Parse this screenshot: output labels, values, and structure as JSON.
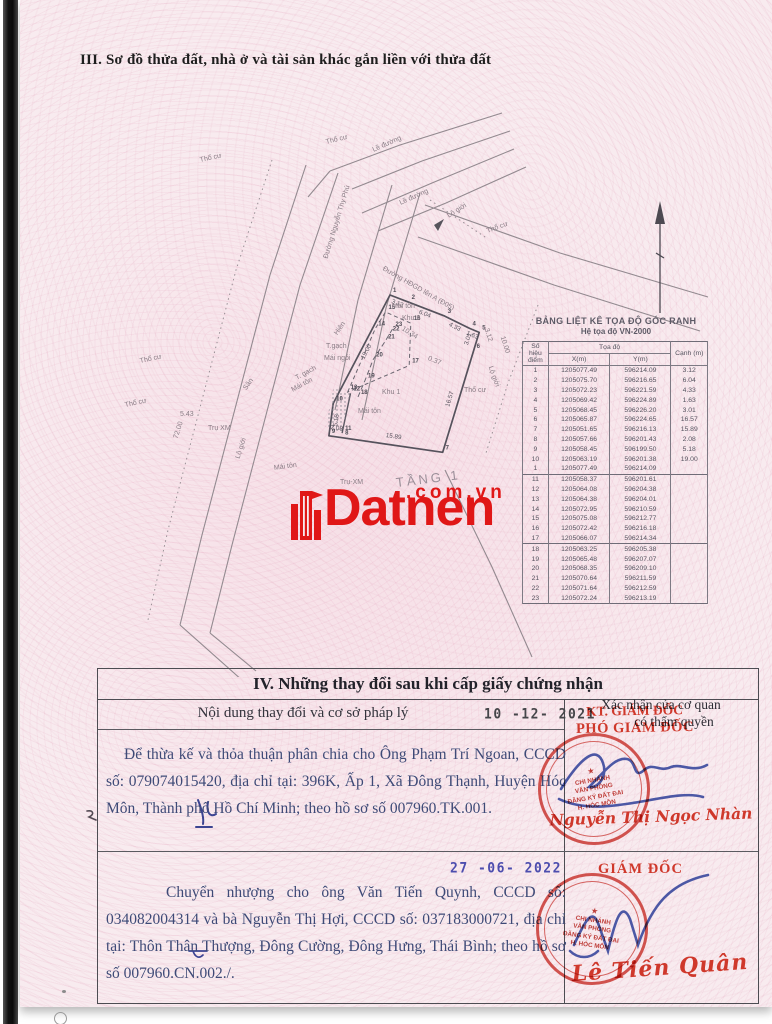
{
  "colors": {
    "stamp_red": "#cf382b",
    "signature_blue": "#3d4b9e",
    "watermark_red": "#e01717",
    "typed_text_blue": "#3e4a77"
  },
  "section3": {
    "title": "III. Sơ đồ thửa đất, nhà ở và tài sản khác gắn liền với thửa đất"
  },
  "coord_table": {
    "title": "BẢNG LIỆT KÊ TỌA ĐỘ GÓC RANH",
    "subtitle": "Hệ tọa độ VN-2000",
    "headers": {
      "point": "Số hiệu điểm",
      "coords": "Tọa độ",
      "x": "X(m)",
      "y": "Y(m)",
      "edge": "Cạnh (m)"
    },
    "rows_part1": [
      [
        "1",
        "1205077.49",
        "596214.09",
        "3.12"
      ],
      [
        "2",
        "1205075.70",
        "596216.65",
        "6.04"
      ],
      [
        "3",
        "1205072.23",
        "596221.59",
        "4.33"
      ],
      [
        "4",
        "1205069.42",
        "596224.89",
        "1.63"
      ],
      [
        "5",
        "1205068.45",
        "596226.20",
        "3.01"
      ],
      [
        "6",
        "1205065.87",
        "596224.65",
        "16.57"
      ],
      [
        "7",
        "1205051.65",
        "596216.13",
        "15.89"
      ],
      [
        "8",
        "1205057.66",
        "596201.43",
        "2.08"
      ],
      [
        "9",
        "1205058.45",
        "596199.50",
        "5.18"
      ],
      [
        "10",
        "1205063.19",
        "596201.38",
        "19.00"
      ],
      [
        "1",
        "1205077.49",
        "596214.09",
        ""
      ]
    ],
    "rows_part2": [
      [
        "11",
        "1205058.37",
        "596201.61",
        ""
      ],
      [
        "12",
        "1205064.08",
        "596204.38",
        ""
      ],
      [
        "13",
        "1205064.38",
        "596204.01",
        ""
      ],
      [
        "14",
        "1205072.95",
        "596210.59",
        ""
      ],
      [
        "15",
        "1205075.08",
        "596212.77",
        ""
      ],
      [
        "16",
        "1205072.42",
        "596216.18",
        ""
      ],
      [
        "17",
        "1205066.07",
        "596214.34",
        ""
      ]
    ],
    "rows_part3": [
      [
        "18",
        "1205063.25",
        "596205.38",
        ""
      ],
      [
        "19",
        "1205065.48",
        "596207.07",
        ""
      ],
      [
        "20",
        "1205068.35",
        "596209.10",
        ""
      ],
      [
        "21",
        "1205070.64",
        "596211.59",
        ""
      ],
      [
        "22",
        "1205071.64",
        "596212.59",
        ""
      ],
      [
        "23",
        "1205072.24",
        "596213.19",
        ""
      ]
    ]
  },
  "map": {
    "labels": [
      {
        "t": "Thổ cư",
        "x": 160,
        "y": 52,
        "r": -12
      },
      {
        "t": "Thổ cư",
        "x": 286,
        "y": 34,
        "r": -14
      },
      {
        "t": "Lề đường",
        "x": 333,
        "y": 42,
        "r": -24
      },
      {
        "t": "Lề đường",
        "x": 360,
        "y": 95,
        "r": -24
      },
      {
        "t": "Lộ giới",
        "x": 408,
        "y": 108,
        "r": -32
      },
      {
        "t": "Thổ cư",
        "x": 447,
        "y": 123,
        "r": -20
      },
      {
        "t": "Đường HĐGD lên A (Đ05)",
        "x": 343,
        "y": 160,
        "r": 30
      },
      {
        "t": "Đường Nguyễn Thy Phú",
        "x": 286,
        "y": 150,
        "r": -73
      },
      {
        "t": "Thổ cư",
        "x": 100,
        "y": 253,
        "r": -12
      },
      {
        "t": "Thổ cư",
        "x": 85,
        "y": 297,
        "r": -12
      },
      {
        "t": "Lộ giới",
        "x": 198,
        "y": 350,
        "r": -72
      },
      {
        "t": "Lộ giới",
        "x": 450,
        "y": 258,
        "r": 70
      },
      {
        "t": "Thổ cư",
        "x": 424,
        "y": 282,
        "r": 0
      },
      {
        "t": "Mái tôn",
        "x": 234,
        "y": 360,
        "r": -8
      },
      {
        "t": "Mái tôn",
        "x": 352,
        "y": 198,
        "r": 0
      },
      {
        "t": "Khu 2",
        "x": 362,
        "y": 210,
        "r": 0
      },
      {
        "t": "Khu 1",
        "x": 342,
        "y": 284,
        "r": 0
      },
      {
        "t": "Mái tôn",
        "x": 318,
        "y": 303,
        "r": 0
      },
      {
        "t": "T.gạch",
        "x": 286,
        "y": 238,
        "r": 0
      },
      {
        "t": "Mái ngói",
        "x": 284,
        "y": 250,
        "r": 0
      },
      {
        "t": "T. gạch",
        "x": 256,
        "y": 270,
        "r": -28
      },
      {
        "t": "Mái tôn",
        "x": 252,
        "y": 282,
        "r": -28
      },
      {
        "t": "Hiên",
        "x": 296,
        "y": 226,
        "r": -55
      },
      {
        "t": "Sân",
        "x": 205,
        "y": 281,
        "r": -55
      },
      {
        "t": "Trụ XM",
        "x": 168,
        "y": 320,
        "r": 0
      },
      {
        "t": "Trụ-XM",
        "x": 300,
        "y": 374,
        "r": 0
      },
      {
        "t": "TẦNG 1",
        "x": 356,
        "y": 370,
        "r": -7,
        "big": true
      },
      {
        "t": "5.43",
        "x": 140,
        "y": 306,
        "r": 0
      },
      {
        "t": "72.00",
        "x": 136,
        "y": 330,
        "r": -72
      },
      {
        "t": "0.37",
        "x": 388,
        "y": 250,
        "r": 22
      },
      {
        "t": "10.34",
        "x": 362,
        "y": 220,
        "r": 32
      },
      {
        "t": "10.00",
        "x": 462,
        "y": 228,
        "r": 72
      },
      {
        "t": "3.12",
        "x": 446,
        "y": 220,
        "r": 72
      }
    ]
  },
  "watermark": {
    "brand": "Datnen",
    "suffix": ".com.vn"
  },
  "section4": {
    "title": "IV. Những thay đổi sau khi cấp giấy chứng nhận",
    "left_header": "Nội dung thay đổi và cơ sở pháp lý",
    "right_header_line1": "Xác nhận của cơ quan",
    "right_header_line2": "có thẩm quyền",
    "entry1": {
      "date": "10 -12- 2021",
      "text": "Để thừa kế và thỏa thuận phân chia cho Ông Phạm Trí Ngoan, CCCD số: 079074015420, địa chỉ tại: 396K, Ấp 1, Xã Đông Thạnh, Huyện Hóc Môn, Thành phố Hồ Chí Minh; theo hồ sơ số 007960.TK.001.",
      "stamp_title_line1": "KT. GIÁM ĐỐC",
      "stamp_title_line2": "PHÓ GIÁM ĐỐC",
      "signer": "Nguyễn Thị Ngọc Nhàn"
    },
    "entry2": {
      "date": "27 -06- 2022",
      "text": "Chuyển nhượng cho ông Văn Tiến Quynh, CCCD số: 034082004314 và bà Nguyễn Thị Hợi, CCCD số: 037183000721, địa chỉ tại: Thôn Thân Thượng, Đông Cường, Đông Hưng, Thái Bình; theo hồ sơ số 007960.CN.002./.",
      "stamp_title": "GIÁM ĐỐC",
      "signer": "Lê Tiến Quân"
    },
    "round_stamp": {
      "star": "★",
      "line1": "CHI NHÁNH",
      "line2": "VĂN PHÒNG",
      "line3": "ĐĂNG KÝ ĐẤT ĐAI",
      "line4": "H. HÓC MÔN"
    }
  }
}
